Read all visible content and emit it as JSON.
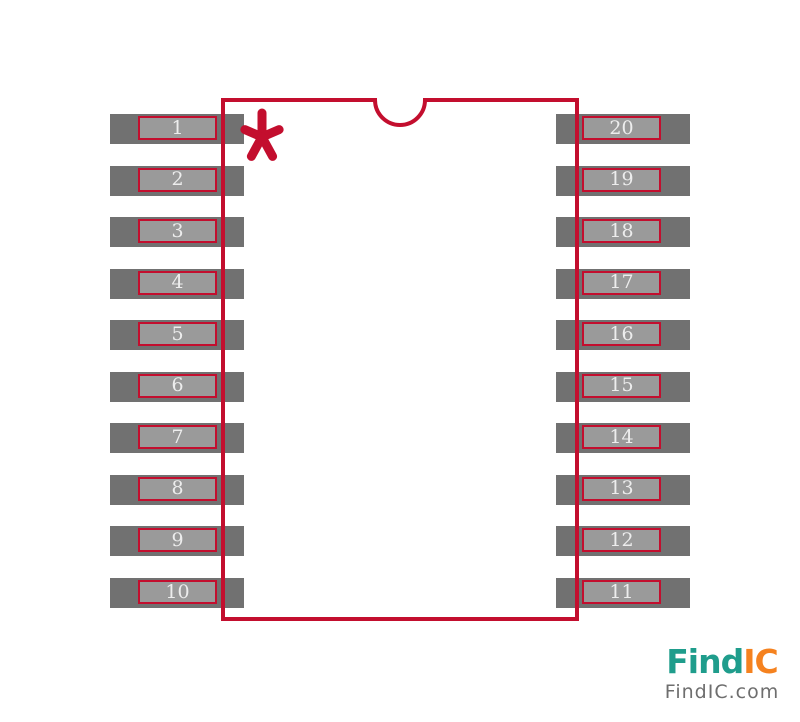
{
  "canvas": {
    "width": 800,
    "height": 722,
    "background_color": "#ffffff"
  },
  "footprint": {
    "package_style": "SOIC-20 footprint drawing",
    "outline_color": "#c30e2e",
    "pad_color": "#717171",
    "inner_pad_color": "#9a9a9a",
    "pin_text_color": "#ededed",
    "pin_count": 20,
    "left_pins": [
      "1",
      "2",
      "3",
      "4",
      "5",
      "6",
      "7",
      "8",
      "9",
      "10"
    ],
    "right_pins": [
      "20",
      "19",
      "18",
      "17",
      "16",
      "15",
      "14",
      "13",
      "12",
      "11"
    ],
    "pin1_marker": "asterisk",
    "notch": "top-center semicircle"
  },
  "logo": {
    "brand_primary": "Find",
    "brand_secondary": "IC",
    "domain": "FindIC.com",
    "primary_color": "#1f9d8c",
    "secondary_color": "#f5821f",
    "domain_color": "#6e6e6e"
  }
}
